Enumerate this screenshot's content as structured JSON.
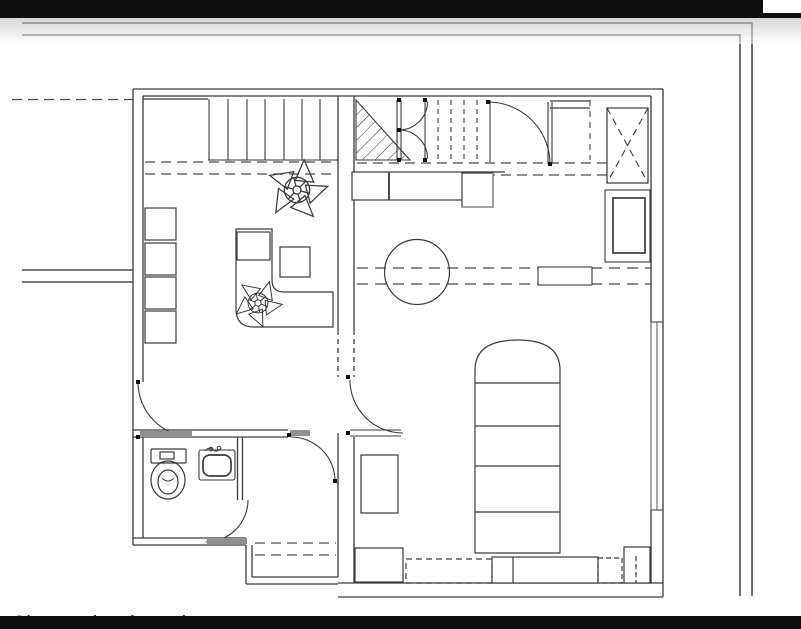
{
  "chrome": {
    "top_bar_color": "#0f0f0f",
    "bottom_bar_color": "#0f0f0f",
    "background": "#ffffff"
  },
  "watermark": {
    "text": "©/ Fernandes Pimentel"
  },
  "drawing": {
    "type": "architectural-floor-plan",
    "line_color": "#3a3a3a",
    "frame_color": "#222222",
    "threshold_color": "#8f8f8f",
    "units": [
      {
        "name": "left-unit",
        "rooms": [
          "office-living-room",
          "bathroom",
          "hall"
        ]
      },
      {
        "name": "right-unit",
        "rooms": [
          "kitchen-living-area",
          "bedroom"
        ]
      }
    ],
    "fixtures": [
      "solid-staircase",
      "overhead-dashed-staircase",
      "stair-void-hatch",
      "double-swing-door",
      "entry-door-arc",
      "elevator-shaft-x",
      "kitchen-counter",
      "kitchen-appliance",
      "round-table",
      "tall-cabinet",
      "bed",
      "nightstand",
      "wardrobe-row",
      "toilet",
      "sink",
      "l-shaped-desk",
      "desk-stools",
      "shelf-column",
      "plant-symbols",
      "door-arcs",
      "window-right-wall"
    ]
  }
}
